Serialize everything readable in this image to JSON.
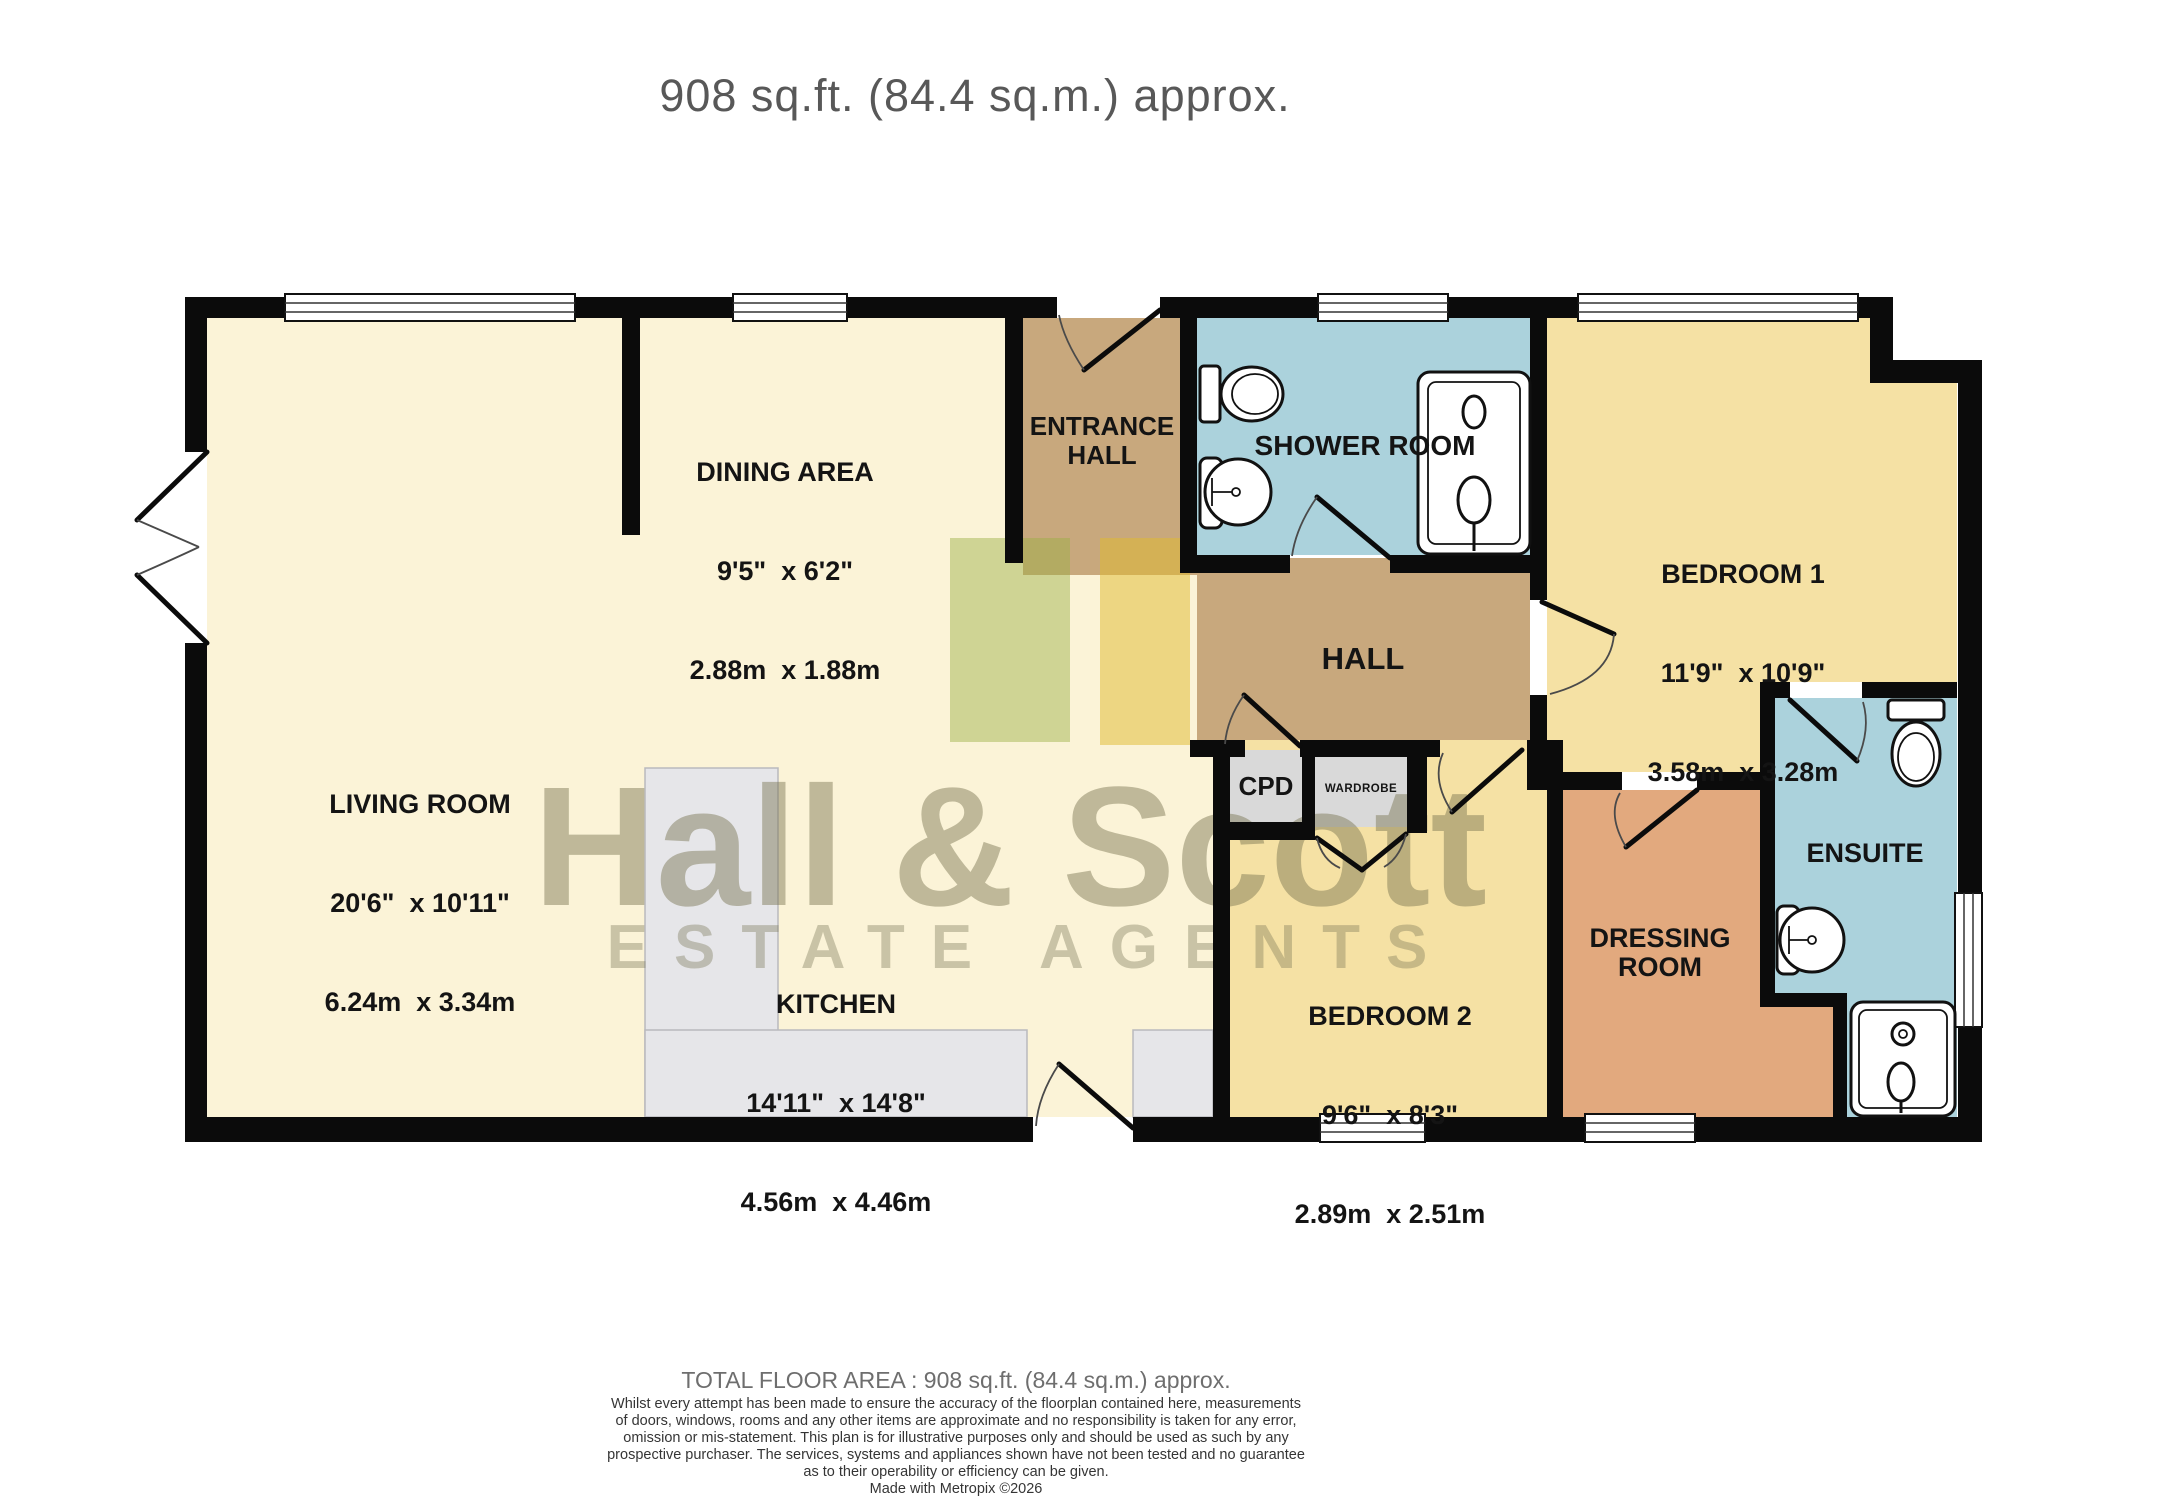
{
  "header": {
    "title": "908 sq.ft. (84.4 sq.m.) approx."
  },
  "watermark": {
    "name": "Hall & Scott",
    "tagline": "ESTATE AGENTS"
  },
  "rooms": {
    "living": {
      "name": "LIVING ROOM",
      "imperial": "20'6\"  x 10'11\"",
      "metric": "6.24m  x 3.34m"
    },
    "dining": {
      "name": "DINING AREA",
      "imperial": "9'5\"  x 6'2\"",
      "metric": "2.88m  x 1.88m"
    },
    "kitchen": {
      "name": "KITCHEN",
      "imperial": "14'11\"  x 14'8\"",
      "metric": "4.56m  x 4.46m"
    },
    "bedroom1": {
      "name": "BEDROOM 1",
      "imperial": "11'9\"  x 10'9\"",
      "metric": "3.58m  x 3.28m"
    },
    "bedroom2": {
      "name": "BEDROOM 2",
      "imperial": "9'6\"  x 8'3\"",
      "metric": "2.89m  x 2.51m"
    },
    "entrance_hall": {
      "name": "ENTRANCE\nHALL"
    },
    "hall": {
      "name": "HALL"
    },
    "shower_room": {
      "name": "SHOWER ROOM"
    },
    "ensuite": {
      "name": "ENSUITE"
    },
    "dressing_room": {
      "name": "DRESSING\nROOM"
    },
    "cpd": {
      "name": "CPD"
    },
    "wardrobe": {
      "name": "WARDROBE"
    }
  },
  "footer": {
    "total": "TOTAL FLOOR AREA : 908 sq.ft. (84.4 sq.m.) approx.",
    "disclaimer": [
      "Whilst every attempt has been made to ensure the accuracy of the floorplan contained here, measurements",
      "of doors, windows, rooms and any other items are approximate and no responsibility is taken for any error,",
      "omission or mis-statement. This plan is for illustrative purposes only and should be used as such by any",
      "prospective purchaser. The services, systems and appliances shown have not been tested and no guarantee",
      "as to their operability or efficiency can be given."
    ],
    "credit": "Made with Metropix ©2026"
  },
  "icons": [
    "toilet-icon",
    "sink-icon",
    "shower-enclosure-icon",
    "shower-tray-icon",
    "window-icon",
    "door-swing-icon"
  ],
  "palette": {
    "wall": "#0B0B0B",
    "room_cream": "#FBF3D7",
    "room_yellow": "#F5E1A4",
    "room_tan": "#C8A87D",
    "room_blue": "#ABD2DC",
    "room_salmon": "#E2A97E",
    "closet_gray": "#D9D9D9",
    "counter_gray": "#E6E6E9",
    "watermark_olive": "#76704E",
    "watermark_green": "#9AB042",
    "watermark_gold": "#E0BA2E",
    "title_gray": "#585858",
    "disclaimer_gray": "#353535"
  }
}
